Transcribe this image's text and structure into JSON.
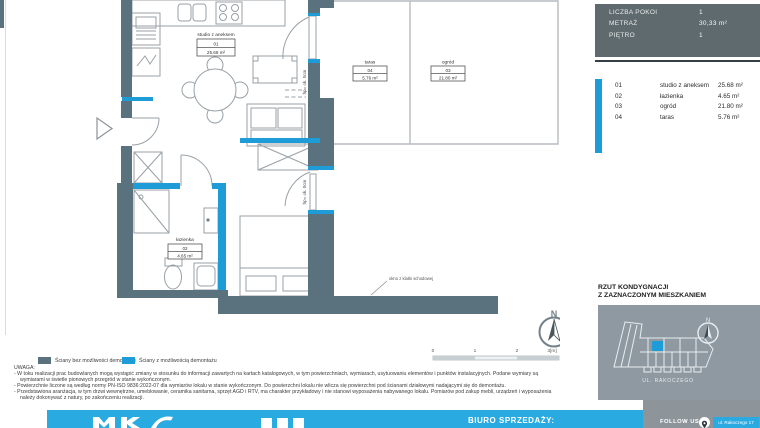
{
  "info_panel": {
    "rows": [
      {
        "label": "LICZBA POKOI",
        "value": "1"
      },
      {
        "label": "METRAŻ",
        "value": "30,33 m²"
      },
      {
        "label": "PIĘTRO",
        "value": "1"
      }
    ]
  },
  "room_list": {
    "items": [
      {
        "no": "01",
        "name": "studio z aneksem",
        "area": "25.68 m²"
      },
      {
        "no": "02",
        "name": "łazienka",
        "area": "4.65 m²"
      },
      {
        "no": "03",
        "name": "ogród",
        "area": "21.80 m²"
      },
      {
        "no": "04",
        "name": "taras",
        "area": "5.76 m²"
      }
    ]
  },
  "plan": {
    "labels": {
      "studio": {
        "name": "studio z aneksem",
        "no": "01",
        "area": "25.68 m²"
      },
      "lazienka": {
        "name": "łazienka",
        "no": "02",
        "area": "4.65 m²"
      },
      "ogrod": {
        "name": "ogród",
        "no": "03",
        "area": "21.80 m²"
      },
      "taras": {
        "name": "taras",
        "no": "04",
        "area": "5.76 m²"
      }
    },
    "annotations": {
      "window_sill_1": "hp= ok. 0cm",
      "window_sill_2": "hp= ok. 0cm",
      "staircase_window": "okno z klatki schodowej"
    },
    "compass": "N",
    "scale_ticks": [
      "0",
      "1",
      "2",
      "3[m]"
    ]
  },
  "legend": {
    "items": [
      {
        "label": "Ściany bez możliwości demontażu",
        "color": "#5a717e"
      },
      {
        "label": "Ściany z możliwością demontażu",
        "color": "#1e9cd7"
      }
    ]
  },
  "notes": {
    "heading": "UWAGA:",
    "bullets": [
      "- W toku realizacji prac budowlanych mogą wystąpić zmiany w stosunku do informacji zawartych na kartach katalogowych, w tym powierzchniach, wymiarach, usytuowaniu elementów i punktów instalacyjnych. Podane wymiary są wymiarami w świetle pionowych przegród w stanie wykończonym.",
      "- Powierzchnie liczone są według normy PN-ISO 9836:2022-07 dla wymiarów lokalu w stanie wykończonym. Do powierzchni lokalu nie wlicza się powierzchni pod ścianami działowymi nadającymi się do demontażu.",
      "- Przedstawiona aranżacja, w tym drzwi wewnętrzne, umeblowanie, ceramika sanitarna, sprzęt AGD i RTV, ma charakter przykładowy i nie stanowi wyposażenia nabywanego lokalu. Pomiarów pod zakup mebli, urządzeń i wyposażenia należy dokonywać z natury, po zakończeniu realizacji."
    ]
  },
  "location_plan": {
    "heading": [
      "RZUT KONDYGNACJI",
      "Z ZAZNACZONYM MIESZKANIEM"
    ],
    "street": "UL. RAKOCZEGO",
    "compass": "N"
  },
  "footer": {
    "sales_office": "BIURO SPRZEDAŻY:",
    "follow_us": "FOLLOW US",
    "address": "ul. Rakoczego 17"
  },
  "colors": {
    "wall": "#5a717e",
    "accent_blue": "#1e9cd7",
    "footer_blue": "#29abe2",
    "info_panel": "#5f6a6e",
    "map_panel": "#8e99a2",
    "footer_gray": "#8d949a"
  }
}
